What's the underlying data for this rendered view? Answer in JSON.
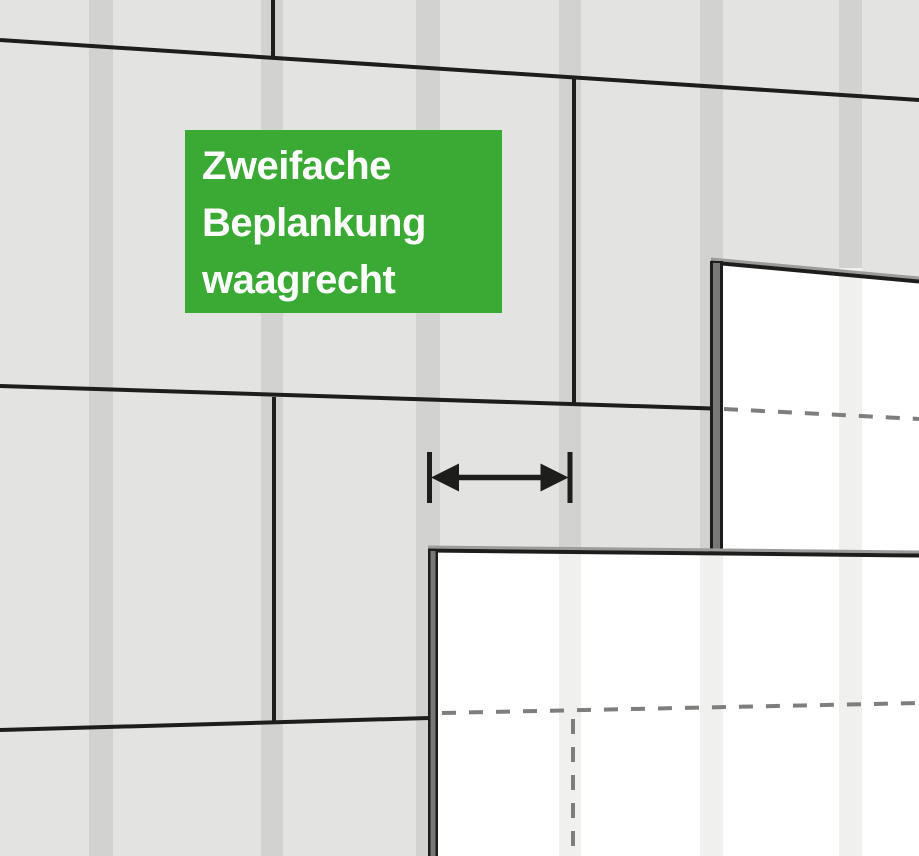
{
  "label": {
    "lines": [
      "Zweifache",
      "Beplankung",
      "waagrecht"
    ]
  },
  "icons": {
    "spacing_arrow": "double-headed-horizontal-arrow-with-end-ticks"
  },
  "colors": {
    "label_background": "#3aaa35",
    "label_text": "#ffffff",
    "wall_background": "#e3e3e2",
    "stud_stripe": "#d2d2d1",
    "panel_white": "#ffffff",
    "panel_faint_stripe": "#f0f0ef",
    "joint_line_black": "#1d1d1b",
    "hidden_joint_dash_gray": "#7e7e7d",
    "panel_edge_gray": "#787877",
    "panel_top_edge_gray": "#9c9c9b"
  }
}
